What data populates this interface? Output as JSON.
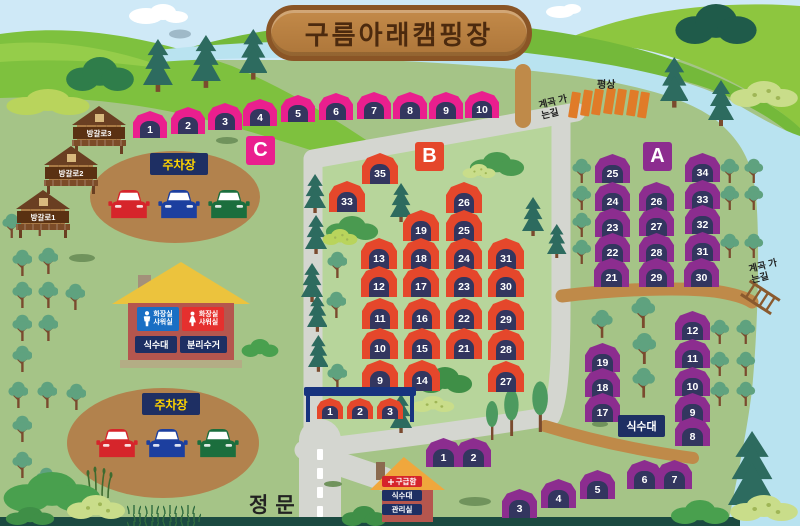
{
  "title": "구름아래캠핑장",
  "signs": {
    "main_gate": "정문",
    "parking": "주차장",
    "water_station": "식수대",
    "valley_path": "계곡 가는길"
  },
  "platforms": {
    "label": "평상",
    "count": 7
  },
  "cabins": [
    {
      "name": "방갈로3",
      "x": 72,
      "y": 106
    },
    {
      "name": "방갈로2",
      "x": 44,
      "y": 146
    },
    {
      "name": "방갈로1",
      "x": 16,
      "y": 190
    }
  ],
  "facility_building": {
    "mens_restroom_line1": "화장실",
    "mens_restroom_line2": "샤워실",
    "womens_restroom_line1": "화장실",
    "womens_restroom_line2": "샤워실",
    "water_station": "식수대",
    "recycling": "분리수거"
  },
  "office_building": {
    "first_aid": "구급함",
    "water_station": "식수대",
    "office": "관리실"
  },
  "sections": {
    "C": {
      "label": "C",
      "color": "#ea1f8e",
      "badge": [
        246,
        136
      ],
      "sites": [
        [
          1,
          150,
          124
        ],
        [
          2,
          188,
          120
        ],
        [
          3,
          225,
          116
        ],
        [
          4,
          260,
          112
        ],
        [
          5,
          298,
          108
        ],
        [
          6,
          336,
          106
        ],
        [
          7,
          374,
          105
        ],
        [
          8,
          410,
          105
        ],
        [
          9,
          446,
          105
        ],
        [
          10,
          482,
          104
        ]
      ]
    },
    "B": {
      "label": "B",
      "color": "#e5472b",
      "badge": [
        415,
        142
      ],
      "sites": [
        [
          35,
          380,
          168
        ],
        [
          33,
          347,
          196
        ],
        [
          26,
          464,
          197
        ],
        [
          19,
          421,
          225
        ],
        [
          25,
          464,
          225
        ],
        [
          13,
          379,
          253
        ],
        [
          18,
          421,
          253
        ],
        [
          24,
          464,
          253
        ],
        [
          31,
          506,
          253
        ],
        [
          12,
          379,
          281
        ],
        [
          17,
          421,
          281
        ],
        [
          23,
          464,
          281
        ],
        [
          30,
          506,
          281
        ],
        [
          11,
          380,
          313
        ],
        [
          16,
          422,
          313
        ],
        [
          22,
          464,
          313
        ],
        [
          29,
          506,
          314
        ],
        [
          10,
          380,
          343
        ],
        [
          15,
          422,
          343
        ],
        [
          21,
          464,
          343
        ],
        [
          28,
          506,
          344
        ],
        [
          9,
          380,
          375
        ],
        [
          14,
          422,
          375
        ],
        [
          27,
          506,
          376
        ]
      ],
      "shelter_sites": [
        [
          1,
          330,
          408
        ],
        [
          2,
          360,
          408
        ],
        [
          3,
          390,
          408
        ]
      ]
    },
    "A": {
      "label": "A",
      "color": "#8c2d8f",
      "badge": [
        643,
        142
      ],
      "sites": [
        [
          25,
          612,
          168
        ],
        [
          34,
          702,
          167
        ],
        [
          24,
          612,
          196
        ],
        [
          26,
          656,
          196
        ],
        [
          33,
          702,
          194
        ],
        [
          23,
          612,
          222
        ],
        [
          27,
          656,
          221
        ],
        [
          32,
          702,
          219
        ],
        [
          22,
          612,
          247
        ],
        [
          28,
          656,
          247
        ],
        [
          31,
          702,
          246
        ],
        [
          21,
          611,
          272
        ],
        [
          29,
          656,
          272
        ],
        [
          30,
          701,
          272
        ],
        [
          12,
          692,
          325
        ],
        [
          11,
          692,
          353
        ],
        [
          10,
          692,
          381
        ],
        [
          9,
          692,
          407
        ],
        [
          8,
          692,
          431
        ],
        [
          19,
          602,
          357
        ],
        [
          18,
          602,
          382
        ],
        [
          17,
          602,
          407
        ],
        [
          1,
          443,
          452
        ],
        [
          2,
          473,
          452
        ],
        [
          3,
          519,
          503
        ],
        [
          4,
          558,
          493
        ],
        [
          5,
          597,
          484
        ],
        [
          6,
          644,
          474
        ],
        [
          7,
          674,
          474
        ]
      ]
    }
  },
  "parking_lots": [
    {
      "label": "주차장",
      "sign": [
        150,
        153
      ],
      "cars": [
        [
          108,
          189
        ],
        [
          158,
          189
        ],
        [
          208,
          189
        ]
      ]
    },
    {
      "label": "주차장",
      "sign": [
        142,
        393
      ],
      "cars": [
        [
          96,
          428
        ],
        [
          146,
          428
        ],
        [
          197,
          428
        ]
      ]
    }
  ],
  "car_colors": [
    "#d6252b",
    "#1c3f9f",
    "#1b6e3d"
  ]
}
